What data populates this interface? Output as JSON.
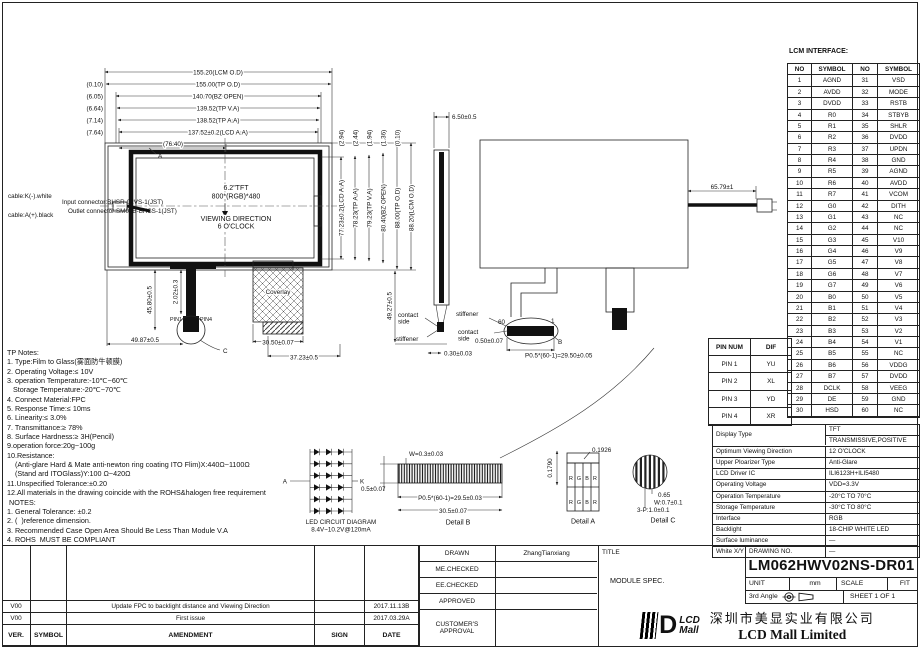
{
  "front": {
    "datum": "A",
    "l1": "6.2\"TFT",
    "l2": "800*(RGB)*480",
    "l3": "VIEWING DIRECTION",
    "l4": "6 O'CLOCK"
  },
  "cable": {
    "k": "cable:K(-).white",
    "a": "cable:A(+).black",
    "input": "Input connector:BHSR-02VS-1(JST)",
    "outlet": "Outlet connector:SM02B-BHSS-1(JST)"
  },
  "dims_top": [
    {
      "offset": "",
      "label": "155.20(LCM O.D)"
    },
    {
      "offset": "(0.10)",
      "label": "155.00(TP O.D)"
    },
    {
      "offset": "(6.05)",
      "label": "140.70(BZ OPEN)"
    },
    {
      "offset": "(6.64)",
      "label": "139.52(TP V.A)"
    },
    {
      "offset": "(7.14)",
      "label": "138.52(TP A.A)"
    },
    {
      "offset": "(7.64)",
      "label": "137.52±0.2(LCD A.A)"
    },
    {
      "offset": "",
      "label": "(76.40)"
    }
  ],
  "dims_right": [
    {
      "offset": "(2.94)",
      "label": "77.23±0.2(LCD A.A)"
    },
    {
      "offset": "(2.44)",
      "label": "78.23(TP A.A)"
    },
    {
      "offset": "(1.94)",
      "label": "79.23(TP V.A)"
    },
    {
      "offset": "(1.36)",
      "label": "80.40(BZ OPEN)"
    },
    {
      "offset": "(0.10)",
      "label": "88.00(TP O.D)"
    },
    {
      "offset": "",
      "label": "88.20(LCM O.D)"
    }
  ],
  "dims": {
    "side_thickness": "6.50±0.5",
    "cable_length": "65.79±1",
    "right_drop": "49.27±0.5",
    "tail_len": "2.02±0.3",
    "tail_drop": "45.80±0.5",
    "tail_offset": "49.87±0.5",
    "pin1": "PIN1",
    "pin4": "PIN4",
    "balloon_c": "C",
    "balloon_b": "B",
    "coverlay": "Coverlay",
    "coverlay_w": "30.50±0.07",
    "coverlay_w2": "37.23±0.5",
    "tp_thick": "0.30±0.03",
    "fpc_thick": "0.50±0.07",
    "fpc_pitch": "P0.5*(60-1)=29.50±0.05",
    "pin60": "60",
    "pin_1": "1",
    "contact": "contact",
    "side": "side",
    "stiffener": "stiffener"
  },
  "led": {
    "a": "A",
    "k": "K",
    "strings": 6,
    "per_string": 3,
    "caption1": "LED CIRCUIT DIAGRAM",
    "caption2": "8.4V~10.2V@120mA"
  },
  "detail_b": {
    "w": "W=0.3±0.03",
    "t": "0.5±0.07",
    "pitch": "P0.5*(60-1)=29.5±0.03",
    "total": "30.5±0.07",
    "caption": "Detail B"
  },
  "detail_a": {
    "h": "0.1790",
    "w": "0.1926",
    "cells": [
      "R",
      "G",
      "B",
      "R"
    ],
    "caption": "Detail A"
  },
  "detail_c": {
    "d1": "0.65",
    "d2": "W:0.7±0.1",
    "d3": "3-P:1.0±0.1",
    "caption": "Detail C"
  },
  "lcm_interface": {
    "title": "LCM INTERFACE:",
    "headers": [
      "NO",
      "SYMBOL",
      "NO",
      "SYMBOL"
    ],
    "rows": [
      [
        "1",
        "AGND",
        "31",
        "VSD"
      ],
      [
        "2",
        "AVDD",
        "32",
        "MODE"
      ],
      [
        "3",
        "DVDD",
        "33",
        "RSTB"
      ],
      [
        "4",
        "R0",
        "34",
        "STBYB"
      ],
      [
        "5",
        "R1",
        "35",
        "SHLR"
      ],
      [
        "6",
        "R2",
        "36",
        "DVDD"
      ],
      [
        "7",
        "R3",
        "37",
        "UPDN"
      ],
      [
        "8",
        "R4",
        "38",
        "GND"
      ],
      [
        "9",
        "R5",
        "39",
        "AGND"
      ],
      [
        "10",
        "R6",
        "40",
        "AVDD"
      ],
      [
        "11",
        "R7",
        "41",
        "VCOM"
      ],
      [
        "12",
        "G0",
        "42",
        "DITH"
      ],
      [
        "13",
        "G1",
        "43",
        "NC"
      ],
      [
        "14",
        "G2",
        "44",
        "NC"
      ],
      [
        "15",
        "G3",
        "45",
        "V10"
      ],
      [
        "16",
        "G4",
        "46",
        "V9"
      ],
      [
        "17",
        "G5",
        "47",
        "V8"
      ],
      [
        "18",
        "G6",
        "48",
        "V7"
      ],
      [
        "19",
        "G7",
        "49",
        "V6"
      ],
      [
        "20",
        "B0",
        "50",
        "V5"
      ],
      [
        "21",
        "B1",
        "51",
        "V4"
      ],
      [
        "22",
        "B2",
        "52",
        "V3"
      ],
      [
        "23",
        "B3",
        "53",
        "V2"
      ],
      [
        "24",
        "B4",
        "54",
        "V1"
      ],
      [
        "25",
        "B5",
        "55",
        "NC"
      ],
      [
        "26",
        "B6",
        "56",
        "VDDG"
      ],
      [
        "27",
        "B7",
        "57",
        "DVDD"
      ],
      [
        "28",
        "DCLK",
        "58",
        "VEEG"
      ],
      [
        "29",
        "DE",
        "59",
        "GND"
      ],
      [
        "30",
        "HSD",
        "60",
        "NC"
      ]
    ]
  },
  "pin_table": {
    "headers": [
      "PIN NUM",
      "DIF"
    ],
    "rows": [
      [
        "PIN 1",
        "YU"
      ],
      [
        "PIN 2",
        "XL"
      ],
      [
        "PIN 3",
        "YD"
      ],
      [
        "PIN 4",
        "XR"
      ]
    ]
  },
  "spec": {
    "display_type_label": "Display Type",
    "display_type_v1": "TFT",
    "display_type_v2": "TRANSMISSIVE,POSITIVE",
    "rows": [
      [
        "Optimum Viewing Direction",
        "12 O'CLOCK"
      ],
      [
        "Upper Ploarizer Type",
        "Anti-Glare"
      ],
      [
        "LCD Driver IC",
        "ILI6123H+ILI5480"
      ],
      [
        "Operating Voltage",
        "VDD=3.3V"
      ],
      [
        "Operation Temperature",
        "-20°C TO 70°C"
      ],
      [
        "Storage Temperature",
        "-30°C TO 80°C"
      ],
      [
        "Interface",
        "RGB"
      ],
      [
        "Backlight",
        "18-CHIP WHITE LED"
      ],
      [
        "Surface luminance",
        "—"
      ],
      [
        "White X/Y",
        "—"
      ]
    ]
  },
  "notes_lines": [
    "TP Notes:",
    "1. Type:Film to Glass(雾面防牛顿膜)",
    "2. Operating Voltage:≤ 10V",
    "3. operation Temperature:-10℃~60℃",
    "   Storage Temperature:-20℃~70℃",
    "4. Connect Material:FPC",
    "5. Response Time:≤ 10ms",
    "6. Linearity:≤ 3.0%",
    "7. Transmittance:≥ 78%",
    "8. Surface Hardness:≥ 3H(Pencil)",
    "9.operation force:20g~100g",
    "10.Resistance:",
    "    (Anti-glare Hard & Mate anti-newton ring coating ITO Flim)X:440Ω~1100Ω",
    "    (Stand ard ITOGlass)Y:100 Ω~420Ω",
    "11.Unspecified Tolerance:±0.20",
    "12.All materials in the drawing coincide with the ROHS&halogen free requirement",
    " NOTES:",
    "1. General Tolerance: ±0.2",
    "2. (  )reference dimension.",
    "3. Recommended Case Open Area Should Be Less Than Module V.A",
    "4. ROHS  MUST BE COMPLIANT"
  ],
  "approval": {
    "drawn_label": "DRAWN",
    "drawn": "ZhangTianxiang",
    "me": "ME.CHECKED",
    "ee": "EE.CHECKED",
    "app": "APPROVED",
    "customer": "CUSTOMER'S APPROVAL"
  },
  "revisions": {
    "header": [
      "VER.",
      "SYMBOL",
      "AMENDMENT",
      "SIGN",
      "DATE"
    ],
    "rows": [
      [
        "V00",
        "",
        "Update FPC to backlight distance and Viewing Direction",
        "",
        "2017.11.13B"
      ],
      [
        "V00",
        "",
        "First issue",
        "",
        "2017.03.29A"
      ]
    ]
  },
  "title_block": {
    "title_label": "TITLE",
    "title": "MODULE SPEC.",
    "drawing_no_label": "DRAWING NO.",
    "drawing_no": "LM062HWV02NS-DR01",
    "unit_label": "UNIT",
    "unit": "mm",
    "scale_label": "SCALE",
    "scale": "FIT",
    "angle": "3rd Angle",
    "sheet": "SHEET 1 OF 1",
    "logo_top": "LCD",
    "logo_bottom": "Mall",
    "company_cn": "深圳市美显实业有限公司",
    "company_en": "LCD Mall Limited"
  }
}
